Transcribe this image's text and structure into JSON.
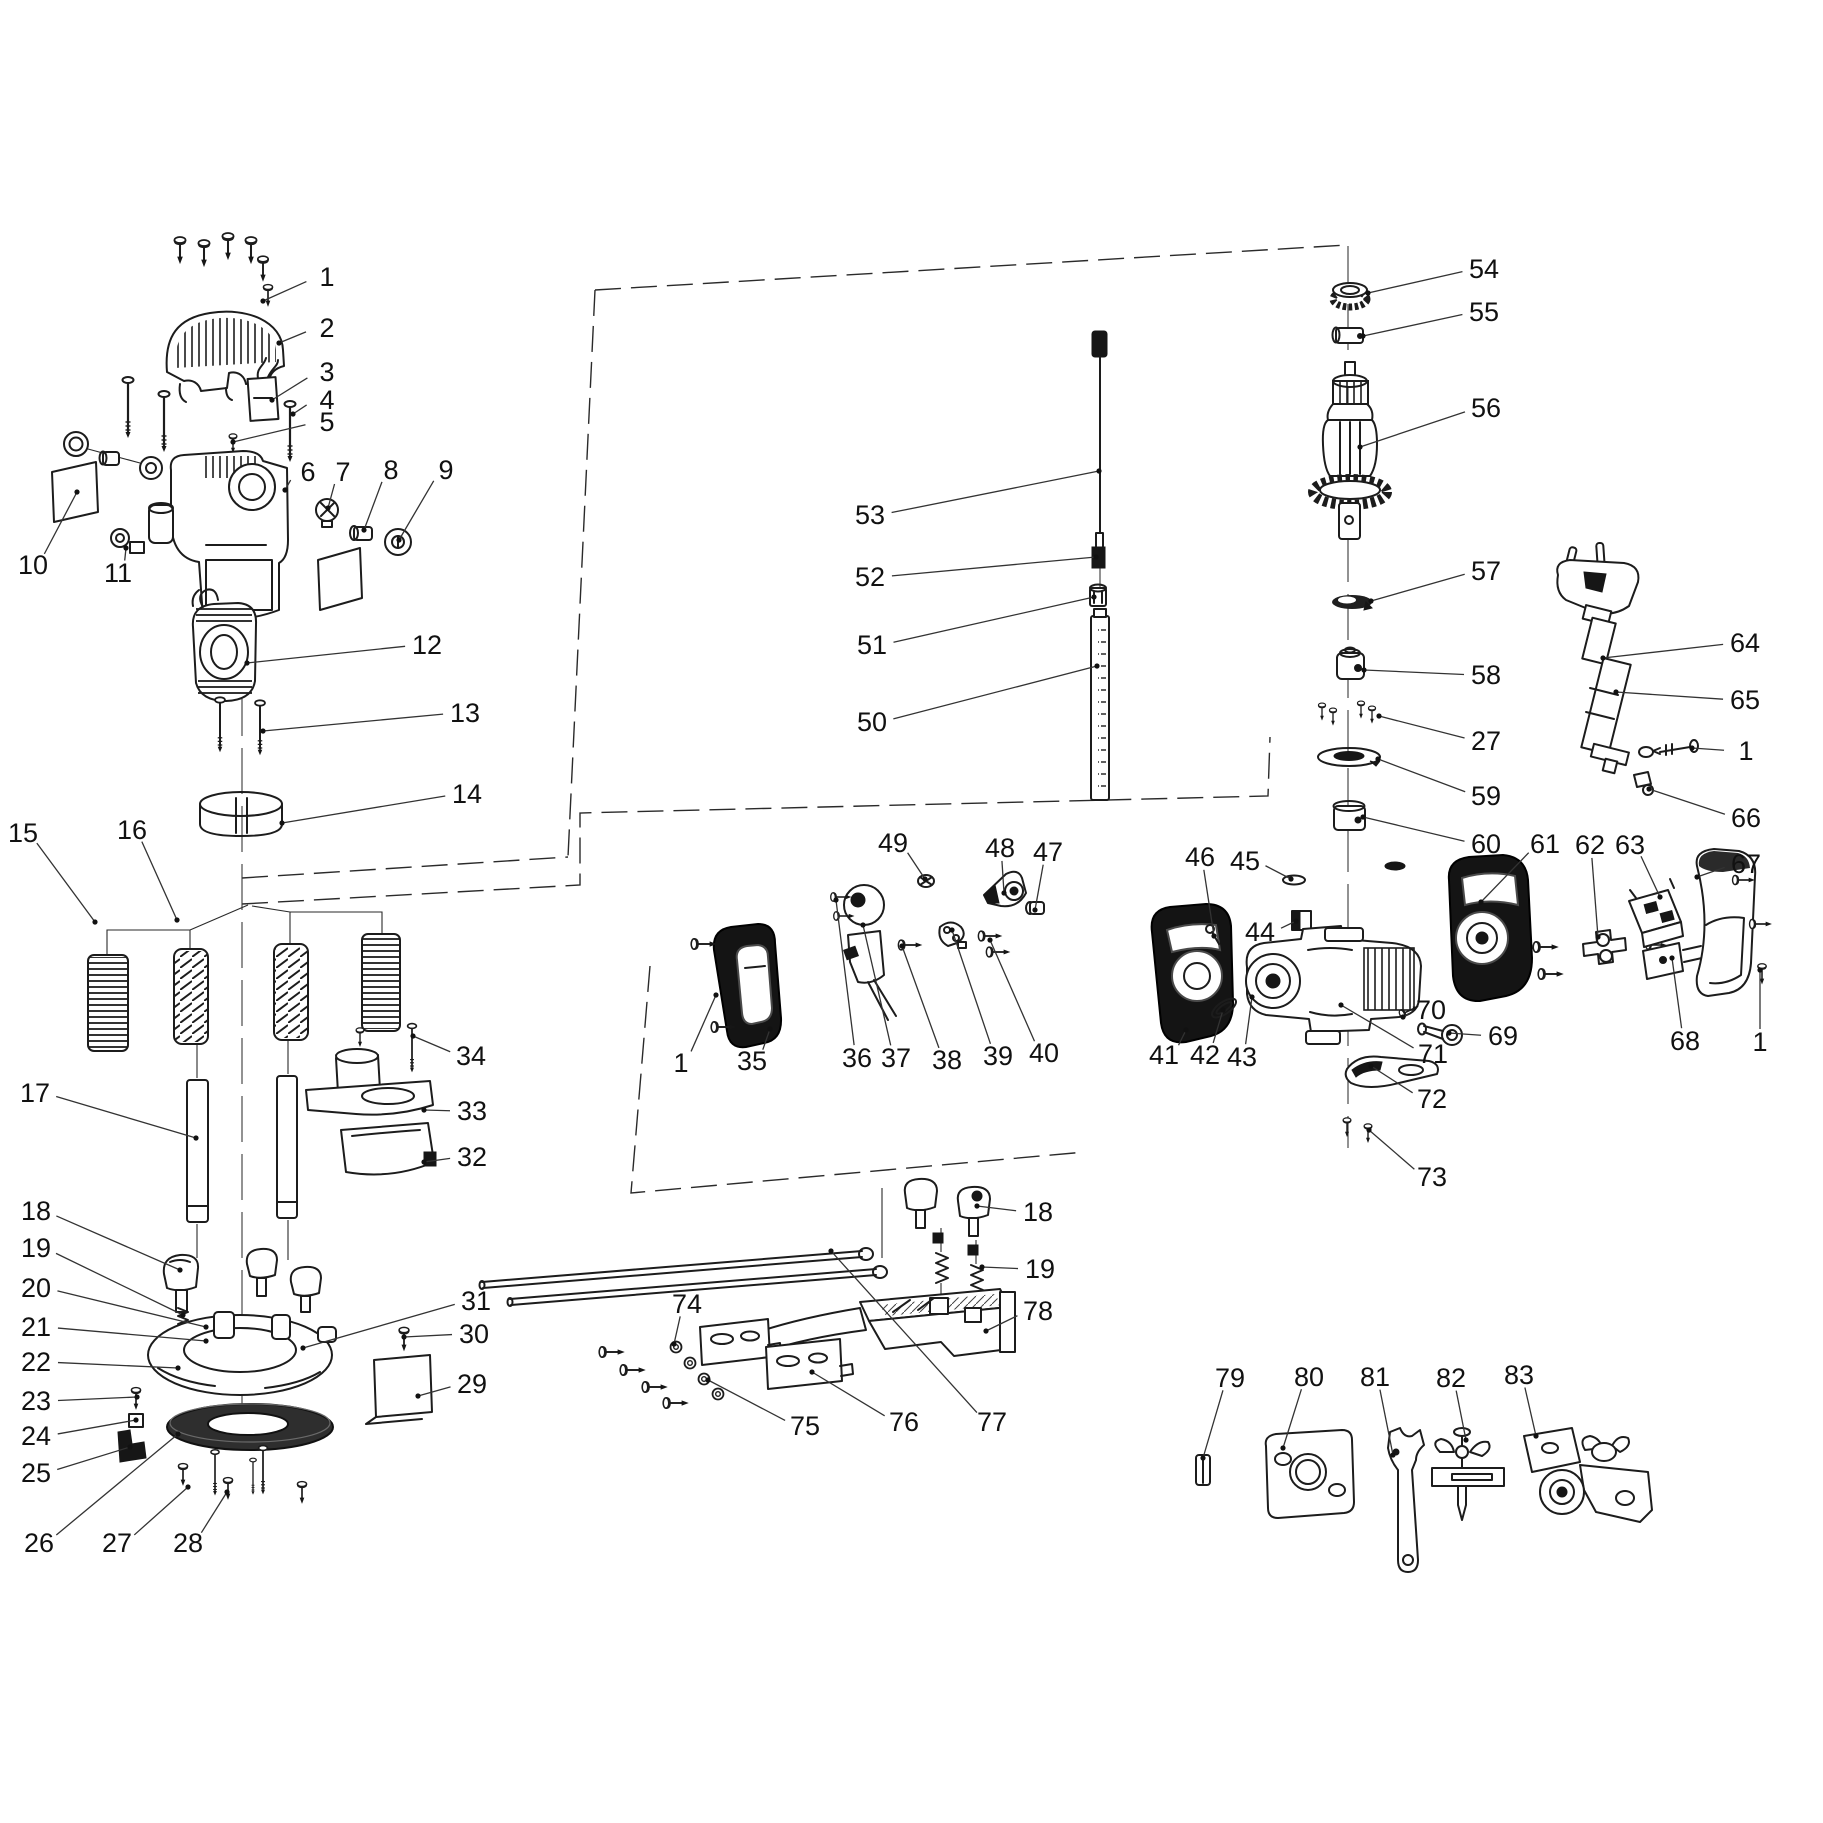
{
  "figure": {
    "type": "exploded-parts-diagram",
    "subject": "plunge router power tool spare parts schematic",
    "background_color": "#ffffff",
    "line_color": "#1c1c1c"
  },
  "labels": [
    {
      "n": "1",
      "x": 327,
      "y": 277,
      "tx": 263,
      "ty": 301
    },
    {
      "n": "2",
      "x": 327,
      "y": 328,
      "tx": 279,
      "ty": 343
    },
    {
      "n": "3",
      "x": 327,
      "y": 372,
      "tx": 272,
      "ty": 400
    },
    {
      "n": "4",
      "x": 327,
      "y": 400,
      "tx": 293,
      "ty": 414
    },
    {
      "n": "5",
      "x": 327,
      "y": 422,
      "tx": 233,
      "ty": 442
    },
    {
      "n": "6",
      "x": 308,
      "y": 472,
      "tx": 285,
      "ty": 490
    },
    {
      "n": "7",
      "x": 343,
      "y": 472,
      "tx": 328,
      "ty": 508
    },
    {
      "n": "8",
      "x": 391,
      "y": 470,
      "tx": 364,
      "ty": 530
    },
    {
      "n": "9",
      "x": 446,
      "y": 470,
      "tx": 399,
      "ty": 540
    },
    {
      "n": "10",
      "x": 33,
      "y": 565,
      "tx": 77,
      "ty": 492
    },
    {
      "n": "11",
      "x": 118,
      "y": 573,
      "tx": 126,
      "ty": 548
    },
    {
      "n": "12",
      "x": 427,
      "y": 645,
      "tx": 247,
      "ty": 663
    },
    {
      "n": "13",
      "x": 465,
      "y": 713,
      "tx": 263,
      "ty": 731
    },
    {
      "n": "14",
      "x": 467,
      "y": 794,
      "tx": 282,
      "ty": 823
    },
    {
      "n": "15",
      "x": 23,
      "y": 833,
      "tx": 95,
      "ty": 922
    },
    {
      "n": "16",
      "x": 132,
      "y": 830,
      "tx": 177,
      "ty": 920
    },
    {
      "n": "17",
      "x": 35,
      "y": 1093,
      "tx": 196,
      "ty": 1138
    },
    {
      "n": "18",
      "x": 36,
      "y": 1211,
      "tx": 180,
      "ty": 1270
    },
    {
      "n": "19",
      "x": 36,
      "y": 1248,
      "tx": 183,
      "ty": 1315
    },
    {
      "n": "20",
      "x": 36,
      "y": 1288,
      "tx": 206,
      "ty": 1327
    },
    {
      "n": "21",
      "x": 36,
      "y": 1327,
      "tx": 206,
      "ty": 1341
    },
    {
      "n": "22",
      "x": 36,
      "y": 1362,
      "tx": 178,
      "ty": 1368
    },
    {
      "n": "23",
      "x": 36,
      "y": 1401,
      "tx": 137,
      "ty": 1397
    },
    {
      "n": "24",
      "x": 36,
      "y": 1436,
      "tx": 136,
      "ty": 1420
    },
    {
      "n": "25",
      "x": 36,
      "y": 1473,
      "tx": 130,
      "ty": 1447
    },
    {
      "n": "26",
      "x": 39,
      "y": 1543,
      "tx": 178,
      "ty": 1434
    },
    {
      "n": "27",
      "x": 117,
      "y": 1543,
      "tx": 188,
      "ty": 1487
    },
    {
      "n": "28",
      "x": 188,
      "y": 1543,
      "tx": 227,
      "ty": 1492
    },
    {
      "n": "29",
      "x": 472,
      "y": 1384,
      "tx": 418,
      "ty": 1396
    },
    {
      "n": "30",
      "x": 474,
      "y": 1334,
      "tx": 404,
      "ty": 1337
    },
    {
      "n": "31",
      "x": 476,
      "y": 1301,
      "tx": 303,
      "ty": 1348
    },
    {
      "n": "32",
      "x": 472,
      "y": 1157,
      "tx": 424,
      "ty": 1162
    },
    {
      "n": "33",
      "x": 472,
      "y": 1111,
      "tx": 424,
      "ty": 1110
    },
    {
      "n": "34",
      "x": 471,
      "y": 1056,
      "tx": 413,
      "ty": 1036
    },
    {
      "n": "1",
      "x": 681,
      "y": 1063,
      "tx": 716,
      "ty": 995
    },
    {
      "n": "35",
      "x": 752,
      "y": 1061,
      "tx": 770,
      "ty": 1029
    },
    {
      "n": "36",
      "x": 857,
      "y": 1058,
      "tx": 836,
      "ty": 900
    },
    {
      "n": "37",
      "x": 896,
      "y": 1058,
      "tx": 863,
      "ty": 925
    },
    {
      "n": "38",
      "x": 947,
      "y": 1060,
      "tx": 902,
      "ty": 946
    },
    {
      "n": "39",
      "x": 998,
      "y": 1056,
      "tx": 952,
      "ty": 930
    },
    {
      "n": "40",
      "x": 1044,
      "y": 1053,
      "tx": 990,
      "ty": 940
    },
    {
      "n": "41",
      "x": 1164,
      "y": 1055,
      "tx": 1186,
      "ty": 1030
    },
    {
      "n": "42",
      "x": 1205,
      "y": 1055,
      "tx": 1223,
      "ty": 1010
    },
    {
      "n": "43",
      "x": 1242,
      "y": 1057,
      "tx": 1252,
      "ty": 997
    },
    {
      "n": "44",
      "x": 1260,
      "y": 932,
      "tx": 1296,
      "ty": 921
    },
    {
      "n": "45",
      "x": 1245,
      "y": 861,
      "tx": 1291,
      "ty": 879
    },
    {
      "n": "46",
      "x": 1200,
      "y": 857,
      "tx": 1214,
      "ty": 936
    },
    {
      "n": "47",
      "x": 1048,
      "y": 852,
      "tx": 1035,
      "ty": 910
    },
    {
      "n": "48",
      "x": 1000,
      "y": 848,
      "tx": 1004,
      "ty": 893
    },
    {
      "n": "49",
      "x": 893,
      "y": 843,
      "tx": 925,
      "ty": 879
    },
    {
      "n": "50",
      "x": 872,
      "y": 722,
      "tx": 1097,
      "ty": 666
    },
    {
      "n": "51",
      "x": 872,
      "y": 645,
      "tx": 1094,
      "ty": 597
    },
    {
      "n": "52",
      "x": 870,
      "y": 577,
      "tx": 1096,
      "ty": 557
    },
    {
      "n": "53",
      "x": 870,
      "y": 515,
      "tx": 1099,
      "ty": 471
    },
    {
      "n": "54",
      "x": 1484,
      "y": 269,
      "tx": 1368,
      "ty": 293
    },
    {
      "n": "55",
      "x": 1484,
      "y": 312,
      "tx": 1363,
      "ty": 336
    },
    {
      "n": "56",
      "x": 1486,
      "y": 408,
      "tx": 1360,
      "ty": 447
    },
    {
      "n": "57",
      "x": 1486,
      "y": 571,
      "tx": 1371,
      "ty": 601
    },
    {
      "n": "58",
      "x": 1486,
      "y": 675,
      "tx": 1364,
      "ty": 670
    },
    {
      "n": "27",
      "x": 1486,
      "y": 741,
      "tx": 1379,
      "ty": 716
    },
    {
      "n": "59",
      "x": 1486,
      "y": 796,
      "tx": 1378,
      "ty": 759
    },
    {
      "n": "60",
      "x": 1486,
      "y": 844,
      "tx": 1363,
      "ty": 817
    },
    {
      "n": "61",
      "x": 1545,
      "y": 844,
      "tx": 1481,
      "ty": 902
    },
    {
      "n": "62",
      "x": 1590,
      "y": 845,
      "tx": 1598,
      "ty": 937
    },
    {
      "n": "63",
      "x": 1630,
      "y": 845,
      "tx": 1660,
      "ty": 897
    },
    {
      "n": "64",
      "x": 1745,
      "y": 643,
      "tx": 1603,
      "ty": 658
    },
    {
      "n": "65",
      "x": 1745,
      "y": 700,
      "tx": 1616,
      "ty": 692
    },
    {
      "n": "1",
      "x": 1746,
      "y": 751,
      "tx": 1692,
      "ty": 748
    },
    {
      "n": "66",
      "x": 1746,
      "y": 818,
      "tx": 1649,
      "ty": 789
    },
    {
      "n": "67",
      "x": 1746,
      "y": 864,
      "tx": 1697,
      "ty": 877
    },
    {
      "n": "68",
      "x": 1685,
      "y": 1041,
      "tx": 1672,
      "ty": 958
    },
    {
      "n": "1",
      "x": 1760,
      "y": 1042,
      "tx": 1760,
      "ty": 970
    },
    {
      "n": "69",
      "x": 1503,
      "y": 1036,
      "tx": 1449,
      "ty": 1033
    },
    {
      "n": "70",
      "x": 1431,
      "y": 1010,
      "tx": 1403,
      "ty": 1017
    },
    {
      "n": "71",
      "x": 1433,
      "y": 1054,
      "tx": 1341,
      "ty": 1005
    },
    {
      "n": "72",
      "x": 1432,
      "y": 1099,
      "tx": 1371,
      "ty": 1066
    },
    {
      "n": "73",
      "x": 1432,
      "y": 1177,
      "tx": 1369,
      "ty": 1130
    },
    {
      "n": "18",
      "x": 1038,
      "y": 1212,
      "tx": 977,
      "ty": 1206
    },
    {
      "n": "19",
      "x": 1040,
      "y": 1269,
      "tx": 982,
      "ty": 1267
    },
    {
      "n": "74",
      "x": 687,
      "y": 1304,
      "tx": 674,
      "ty": 1344
    },
    {
      "n": "75",
      "x": 805,
      "y": 1426,
      "tx": 708,
      "ty": 1380
    },
    {
      "n": "76",
      "x": 904,
      "y": 1422,
      "tx": 812,
      "ty": 1372
    },
    {
      "n": "77",
      "x": 992,
      "y": 1422,
      "tx": 831,
      "ty": 1251
    },
    {
      "n": "78",
      "x": 1038,
      "y": 1311,
      "tx": 986,
      "ty": 1331
    },
    {
      "n": "79",
      "x": 1230,
      "y": 1378,
      "tx": 1203,
      "ty": 1458
    },
    {
      "n": "80",
      "x": 1309,
      "y": 1377,
      "tx": 1283,
      "ty": 1448
    },
    {
      "n": "81",
      "x": 1375,
      "y": 1377,
      "tx": 1393,
      "ty": 1455
    },
    {
      "n": "82",
      "x": 1451,
      "y": 1378,
      "tx": 1466,
      "ty": 1440
    },
    {
      "n": "83",
      "x": 1519,
      "y": 1375,
      "tx": 1536,
      "ty": 1436
    }
  ]
}
